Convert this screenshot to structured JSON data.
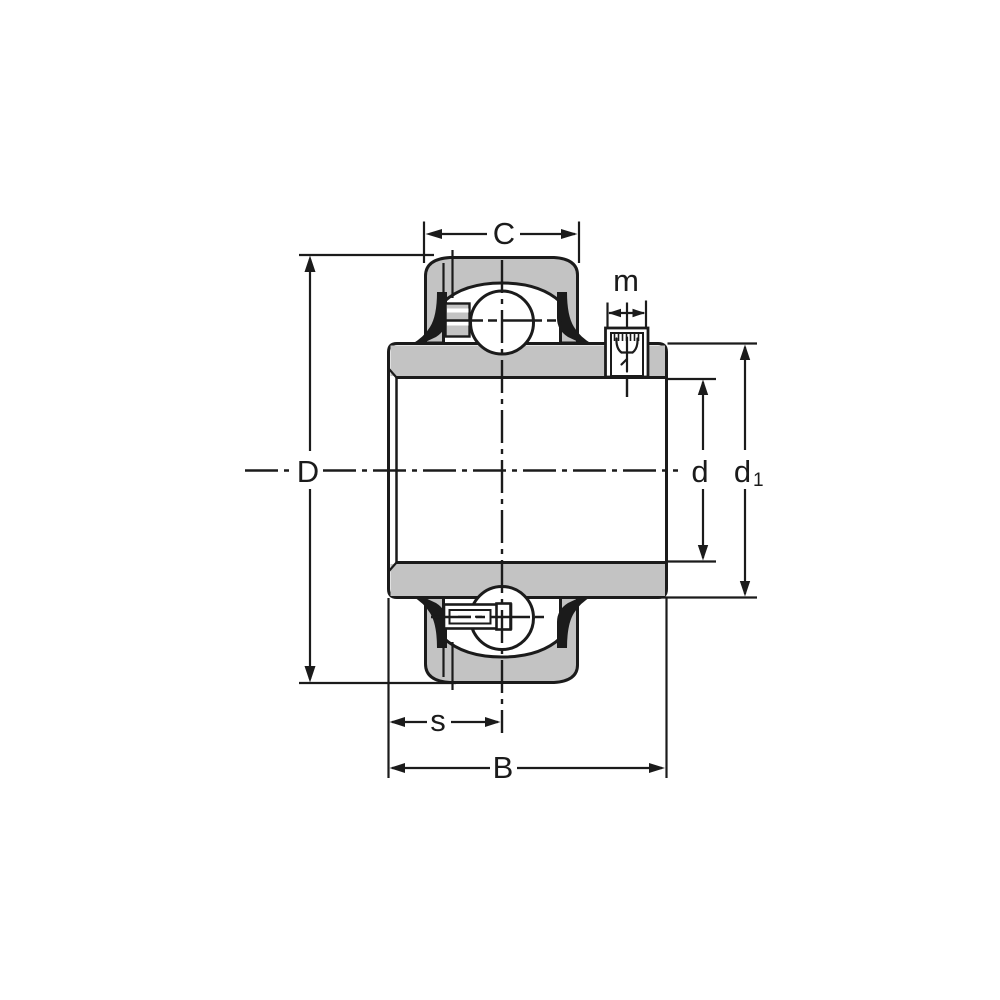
{
  "colors": {
    "line": "#1b1b1b",
    "metal_gray": "#c3c3c3",
    "background": "#ffffff"
  },
  "labels": {
    "C": "C",
    "m": "m",
    "D": "D",
    "d": "d",
    "d1_main": "d",
    "d1_sub": "1",
    "s": "s",
    "B": "B"
  }
}
